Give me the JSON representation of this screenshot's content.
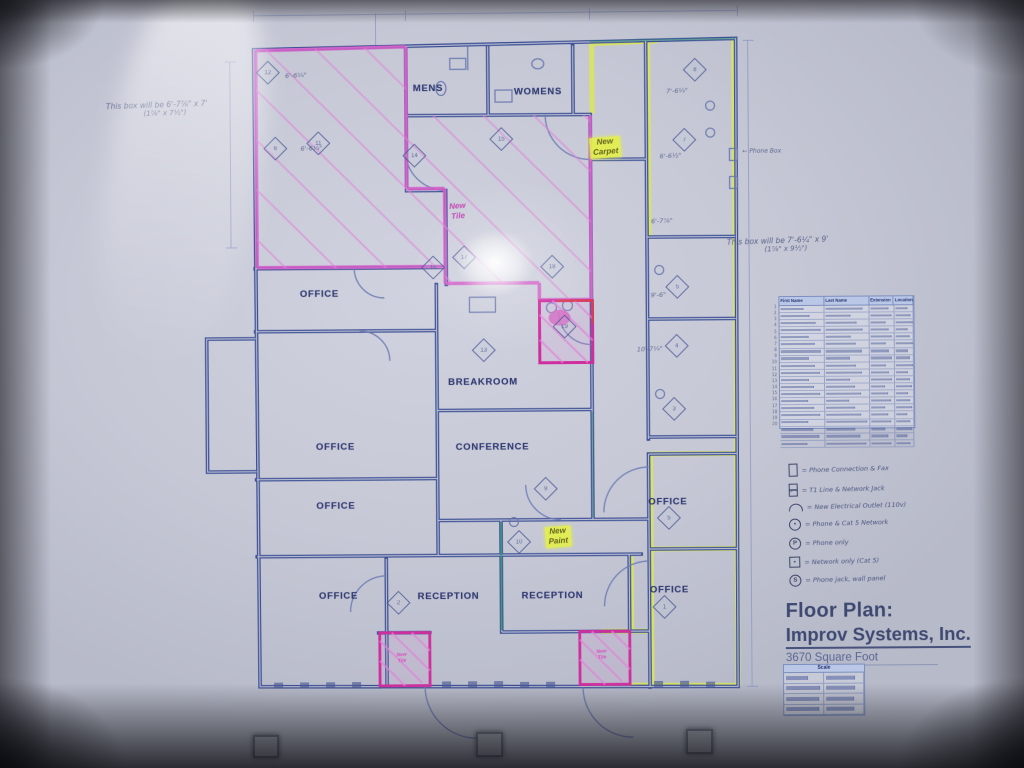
{
  "plan": {
    "rooms": [
      {
        "label": "MENS",
        "x": 430,
        "y": 88
      },
      {
        "label": "WOMENS",
        "x": 540,
        "y": 92
      },
      {
        "label": "OFFICE",
        "x": 320,
        "y": 293
      },
      {
        "label": "OFFICE",
        "x": 335,
        "y": 446
      },
      {
        "label": "OFFICE",
        "x": 335,
        "y": 505
      },
      {
        "label": "BREAKROOM",
        "x": 483,
        "y": 382
      },
      {
        "label": "CONFERENCE",
        "x": 492,
        "y": 447
      },
      {
        "label": "OFFICE",
        "x": 337,
        "y": 595
      },
      {
        "label": "RECEPTION",
        "x": 447,
        "y": 596
      },
      {
        "label": "RECEPTION",
        "x": 551,
        "y": 596
      },
      {
        "label": "OFFICE",
        "x": 667,
        "y": 503
      },
      {
        "label": "OFFICE",
        "x": 668,
        "y": 591
      }
    ],
    "markers": [
      {
        "label": "12",
        "x": 270,
        "y": 71
      },
      {
        "label": "6",
        "x": 277,
        "y": 147
      },
      {
        "label": "11",
        "x": 320,
        "y": 142
      },
      {
        "label": "14",
        "x": 416,
        "y": 155
      },
      {
        "label": "15",
        "x": 503,
        "y": 139
      },
      {
        "label": "16",
        "x": 434,
        "y": 267
      },
      {
        "label": "17",
        "x": 465,
        "y": 257
      },
      {
        "label": "18",
        "x": 553,
        "y": 267
      },
      {
        "label": "19",
        "x": 565,
        "y": 327
      },
      {
        "label": "13",
        "x": 484,
        "y": 350
      },
      {
        "label": "9",
        "x": 545,
        "y": 489
      },
      {
        "label": "10",
        "x": 518,
        "y": 542
      },
      {
        "label": "8",
        "x": 697,
        "y": 71
      },
      {
        "label": "7",
        "x": 686,
        "y": 141
      },
      {
        "label": "5",
        "x": 678,
        "y": 288
      },
      {
        "label": "4",
        "x": 677,
        "y": 347
      },
      {
        "label": "3",
        "x": 674,
        "y": 410
      },
      {
        "label": "5",
        "x": 668,
        "y": 519
      },
      {
        "label": "1",
        "x": 663,
        "y": 608
      },
      {
        "label": "2",
        "x": 397,
        "y": 602
      }
    ],
    "dim_notes": [
      {
        "text": "6'-6¼\"",
        "x": 298,
        "y": 74
      },
      {
        "text": "6'-6¼\"",
        "x": 313,
        "y": 147
      },
      {
        "text": "7'-6¼\"",
        "x": 679,
        "y": 92
      },
      {
        "text": "6'-6½\"",
        "x": 672,
        "y": 157
      },
      {
        "text": "6'-7⅞\"",
        "x": 663,
        "y": 222
      },
      {
        "text": "9'-6\"",
        "x": 659,
        "y": 296
      },
      {
        "text": "10'-7¼\"",
        "x": 650,
        "y": 350
      }
    ],
    "highlight_notes": [
      {
        "style": "yellow",
        "line1": "New",
        "line2": "Carpet",
        "x": 607,
        "y": 148
      },
      {
        "style": "yellow",
        "line1": "New",
        "line2": "Paint",
        "x": 557,
        "y": 537
      },
      {
        "style": "pink",
        "line1": "New",
        "line2": "Tile",
        "x": 459,
        "y": 211
      },
      {
        "style": "pink-small",
        "line1": "New",
        "line2": "Tile",
        "x": 400,
        "y": 658
      },
      {
        "style": "pink-small",
        "line1": "New",
        "line2": "Tile",
        "x": 600,
        "y": 656
      }
    ],
    "margin_note": "← Phone Box"
  },
  "annotations": {
    "top_left": {
      "line1": "This box will be 6'-7⅞\" x 7'",
      "line2": "(1⅞\" x 7½\")"
    },
    "right": {
      "line1": "This box will be 7'-6¼\" x 9'",
      "line2": "(1⅞\" x 9½\")"
    }
  },
  "table": {
    "headers": [
      "First Name",
      "Last Name",
      "Extension",
      "Location"
    ],
    "row_count": 20
  },
  "legend": {
    "items": [
      {
        "symbol": "box",
        "glyph": "",
        "text": "= Phone Connection & Fax"
      },
      {
        "symbol": "box2",
        "glyph": "",
        "text": "= T1 Line & Network Jack"
      },
      {
        "symbol": "arc",
        "glyph": "",
        "text": "= New Electrical Outlet (110v)"
      },
      {
        "symbol": "circle",
        "glyph": "•",
        "text": "= Phone & Cat 5 Network"
      },
      {
        "symbol": "circle",
        "glyph": "P",
        "text": "= Phone only"
      },
      {
        "symbol": "square",
        "glyph": "•",
        "text": "= Network only (Cat 5)"
      },
      {
        "symbol": "circle",
        "glyph": "S",
        "text": "= Phone jack, wall panel"
      }
    ]
  },
  "title_block": {
    "line1": "Floor Plan:",
    "line2": "Improv Systems, Inc.",
    "line3": "3670 Square Foot"
  },
  "scale_table": {
    "header": "Scale",
    "rows": 4,
    "cols": 2
  },
  "colors": {
    "wall_blue": "#3a4e94",
    "highlight_pink": "#d35cc8",
    "highlight_yellow": "#dbe84e",
    "vestibule_pink": "#cf2f9e"
  }
}
